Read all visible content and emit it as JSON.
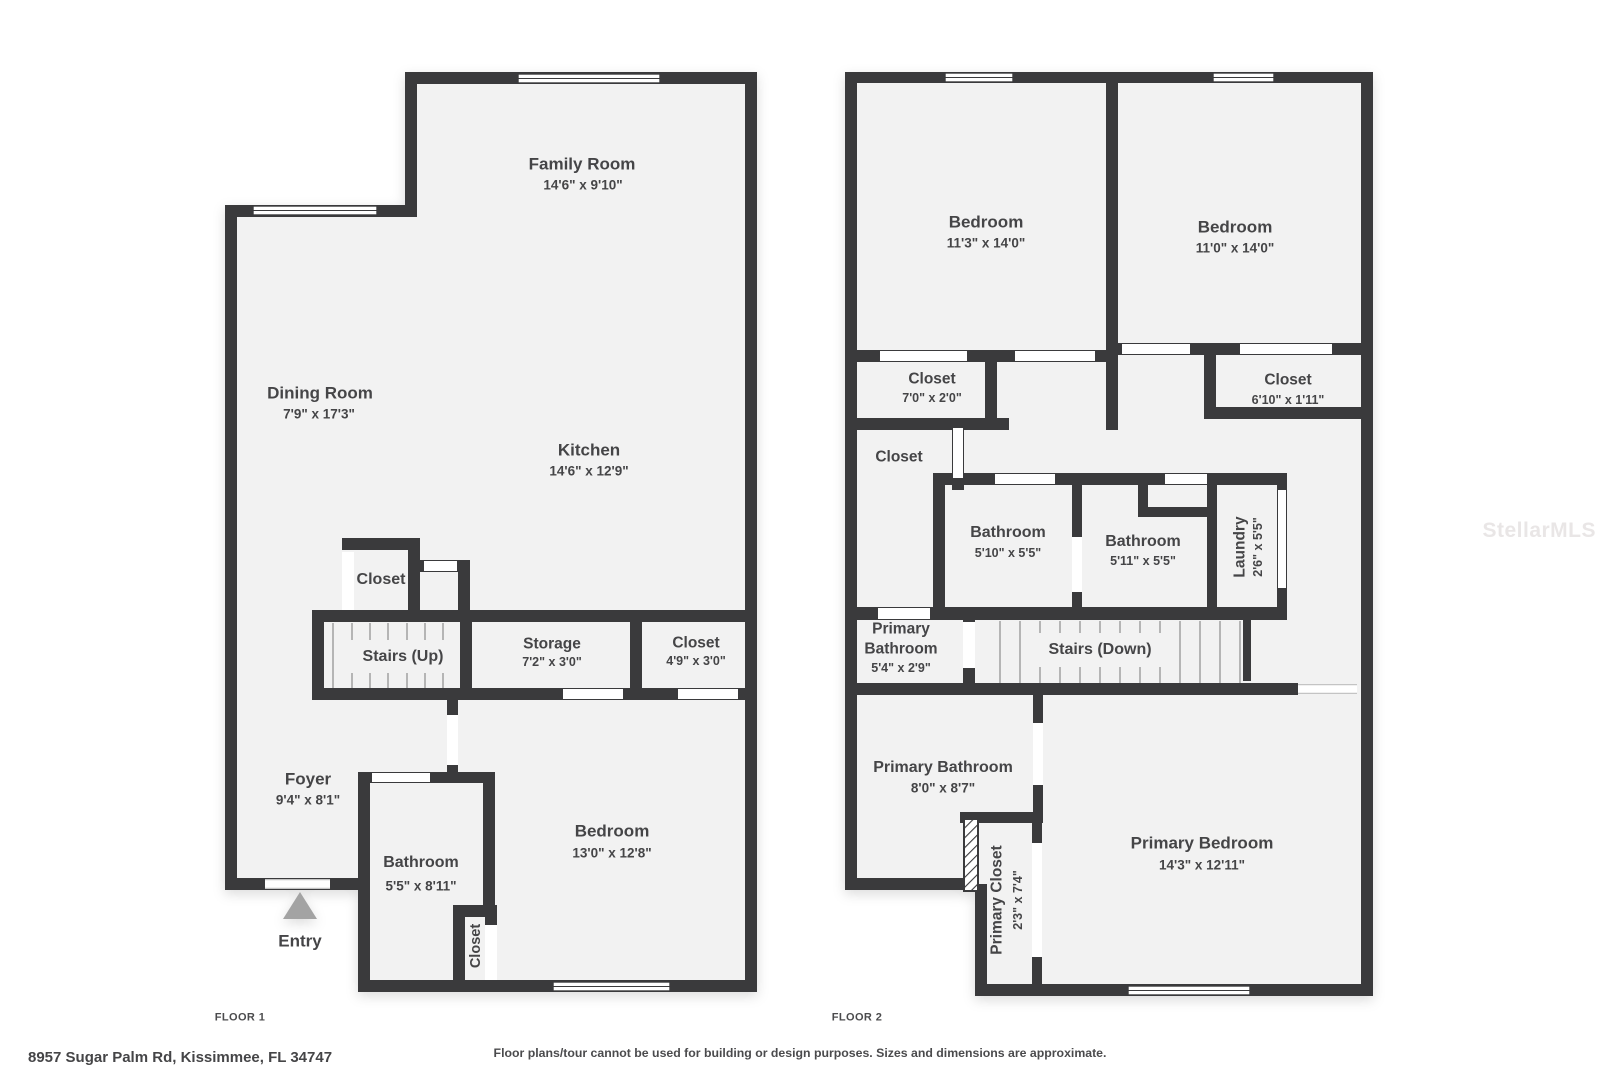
{
  "colors": {
    "wall": "#3a3a3c",
    "floor_fill": "#f2f2f2",
    "label_text": "#454547",
    "tread": "#b5b5b5",
    "entry_arrow": "#a3a3a3",
    "watermark_color": "#e9e6e6",
    "footer_text": "#4b4b4d"
  },
  "watermark": "StellarMLS",
  "floor1": {
    "caption": "FLOOR 1",
    "rooms": {
      "family_room": {
        "name": "Family Room",
        "dims": "14'6\" x 9'10\""
      },
      "dining_room": {
        "name": "Dining Room",
        "dims": "7'9\" x 17'3\""
      },
      "kitchen": {
        "name": "Kitchen",
        "dims": "14'6\" x 12'9\""
      },
      "closet_hall": {
        "name": "Closet"
      },
      "stairs": {
        "name": "Stairs (Up)"
      },
      "storage": {
        "name": "Storage",
        "dims": "7'2\" x 3'0\""
      },
      "closet_stairs": {
        "name": "Closet",
        "dims": "4'9\" x 3'0\""
      },
      "foyer": {
        "name": "Foyer",
        "dims": "9'4\" x 8'1\""
      },
      "bathroom": {
        "name": "Bathroom",
        "dims": "5'5\" x 8'11\""
      },
      "closet_bedroom": {
        "name": "Closet"
      },
      "bedroom": {
        "name": "Bedroom",
        "dims": "13'0\" x 12'8\""
      },
      "entry": {
        "name": "Entry"
      }
    }
  },
  "floor2": {
    "caption": "FLOOR 2",
    "rooms": {
      "bedroom_left": {
        "name": "Bedroom",
        "dims": "11'3\" x 14'0\""
      },
      "bedroom_right": {
        "name": "Bedroom",
        "dims": "11'0\" x 14'0\""
      },
      "closet_left": {
        "name": "Closet",
        "dims": "7'0\" x 2'0\""
      },
      "closet_right": {
        "name": "Closet",
        "dims": "6'10\" x 1'11\""
      },
      "closet_hall": {
        "name": "Closet"
      },
      "bathroom_left": {
        "name": "Bathroom",
        "dims": "5'10\" x 5'5\""
      },
      "bathroom_right": {
        "name": "Bathroom",
        "dims": "5'11\" x 5'5\""
      },
      "laundry": {
        "name": "Laundry",
        "dims": "2'6\" x 5'5\""
      },
      "primary_bathroom_small": {
        "name_line1": "Primary",
        "name_line2": "Bathroom",
        "dims": "5'4\" x 2'9\""
      },
      "stairs": {
        "name": "Stairs (Down)"
      },
      "primary_bathroom": {
        "name": "Primary Bathroom",
        "dims": "8'0\" x 8'7\""
      },
      "primary_closet": {
        "name": "Primary Closet",
        "dims": "2'3\" x 7'4\""
      },
      "primary_bedroom": {
        "name": "Primary Bedroom",
        "dims": "14'3\" x 12'11\""
      }
    }
  },
  "footer": {
    "address": "8957 Sugar Palm Rd, Kissimmee, FL 34747",
    "disclaimer": "Floor plans/tour cannot be used for building or design purposes. Sizes and dimensions are approximate."
  }
}
